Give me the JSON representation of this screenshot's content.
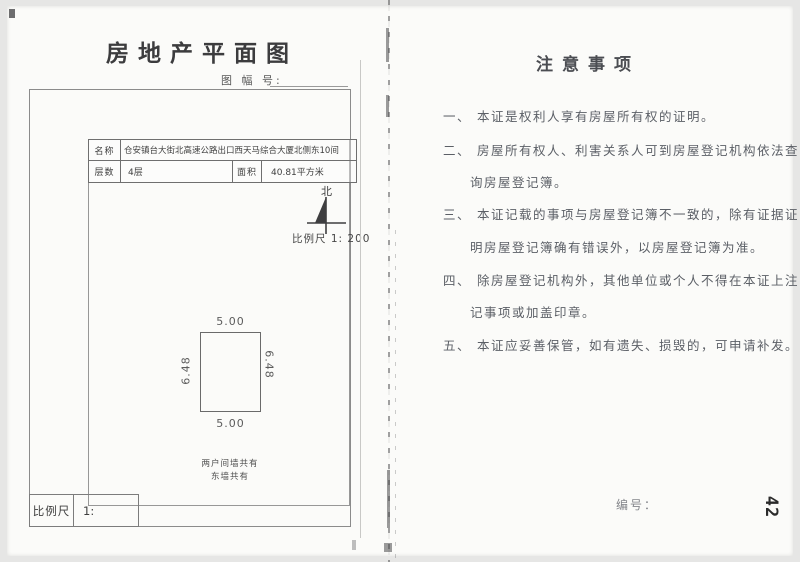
{
  "left": {
    "title": "房地产平面图",
    "map_sheet_label": "图 幅 号:",
    "table": {
      "name_label": "名称",
      "name_value": "仓安镇台大街北高速公路出口西天马综合大厦北侧东10间",
      "floors_label": "层数",
      "floors_value": "4层",
      "area_label": "面积",
      "area_value": "40.81平方米"
    },
    "north_label": "北",
    "scale_note": "比例尺 1: 200",
    "plan": {
      "dim_top": "5.00",
      "dim_bottom": "5.00",
      "dim_left": "6.48",
      "dim_right": "6.48",
      "wall_note_line1": "两户间墙共有",
      "wall_note_line2": "东墙共有"
    },
    "scale_box": {
      "label": "比例尺",
      "value": "1:"
    }
  },
  "right": {
    "title": "注意事项",
    "notes": [
      {
        "num": "一、",
        "lines": [
          "本证是权利人享有房屋所有权的证明。"
        ]
      },
      {
        "num": "二、",
        "lines": [
          "房屋所有权人、利害关系人可到房屋登记机构依法查",
          "询房屋登记簿。"
        ]
      },
      {
        "num": "三、",
        "lines": [
          "本证记载的事项与房屋登记簿不一致的，除有证据证",
          "明房屋登记簿确有错误外，以房屋登记簿为准。"
        ]
      },
      {
        "num": "四、",
        "lines": [
          "除房屋登记机构外，其他单位或个人不得在本证上注",
          "记事项或加盖印章。"
        ]
      },
      {
        "num": "五、",
        "lines": [
          "本证应妥善保管，如有遗失、损毁的，可申请补发。"
        ]
      }
    ],
    "serial_label": "编号：",
    "page_number": "42"
  },
  "colors": {
    "paper": "#fbfbf9",
    "platen": "#e6e6e5",
    "line": "#8b8b8b",
    "ink": "#4a4a4a"
  }
}
